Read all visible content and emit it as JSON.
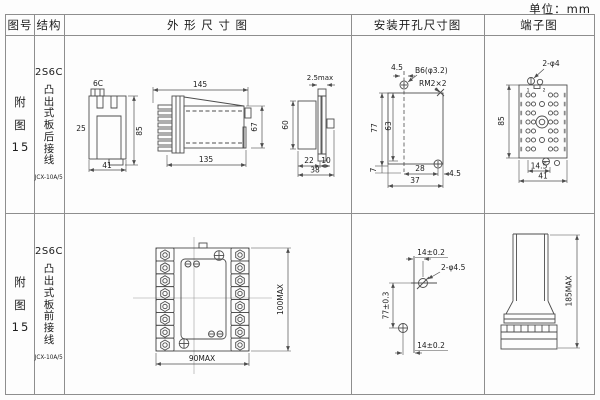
{
  "unit_label": "单位：mm",
  "colors": {
    "line": "#4d4d4d",
    "grid": "#8e8e8e",
    "text": "#1c1c1c"
  },
  "header": {
    "fig_no": "图号",
    "structure": "结构",
    "outline": "外 形 尺 寸 图",
    "install": "安装开孔尺寸图",
    "terminal": "端子图"
  },
  "rows": [
    {
      "fig": {
        "line1": "附",
        "line2": "图",
        "line3": "15"
      },
      "model": "2S6C",
      "structure_text": "凸出式板后接线",
      "submodel": "JCX-10A/5",
      "outline": {
        "front": {
          "top": "6C",
          "left": "25",
          "height": "85",
          "width": "41"
        },
        "side": {
          "top": "145",
          "bottom": "135",
          "height": "67"
        },
        "end": {
          "top": "2.5max",
          "height": "60",
          "w1": "22",
          "w2": "10",
          "w_total": "38"
        }
      },
      "install": {
        "offset_top": "4.5",
        "hole_label": "B6(φ3.2)",
        "screw_label": "RM2×2",
        "h_outer": "77",
        "h_inner": "63",
        "h_base": "7",
        "w_inner": "28",
        "offset_right": "4.5",
        "w_outer": "37"
      },
      "terminal": {
        "hole_label": "2-φ4",
        "height": "85",
        "w_inner": "14.5",
        "w_outer": "41",
        "pin1": "1",
        "pin2": "2"
      }
    },
    {
      "fig": {
        "line1": "附",
        "line2": "图",
        "line3": "15"
      },
      "model": "2S6C",
      "structure_text": "凸出式板前接线",
      "submodel": "JCX-10A/5",
      "outline": {
        "width": "90MAX",
        "height": "100MAX"
      },
      "install": {
        "offset_top": "14±0.2",
        "hole_label": "2-φ4.5",
        "height": "77±0.3",
        "offset_bottom": "14±0.2"
      },
      "terminal": {
        "height": "185MAX"
      }
    }
  ]
}
